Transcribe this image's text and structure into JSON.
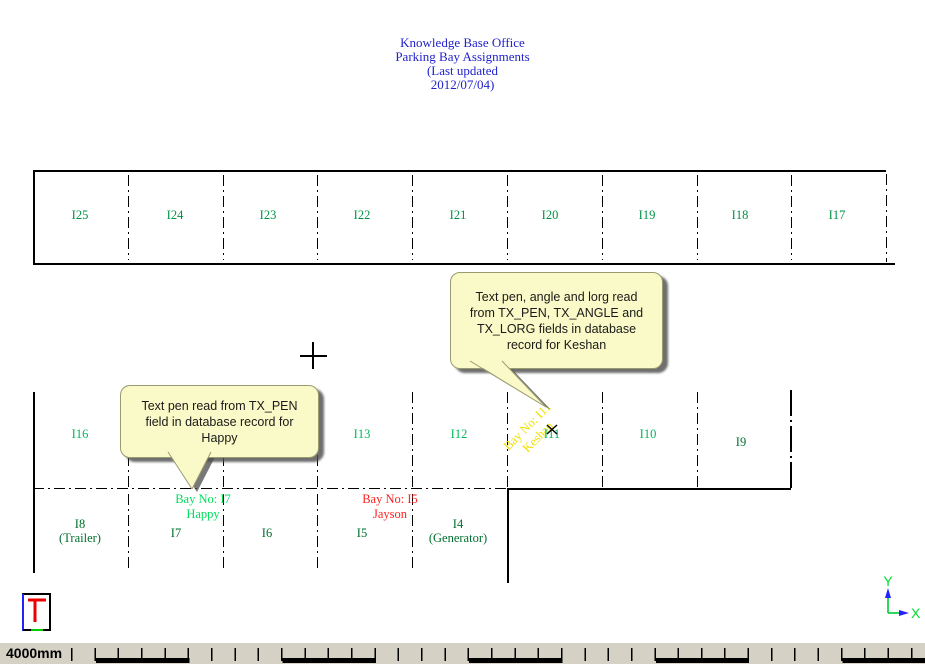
{
  "title": {
    "lines": [
      "Knowledge Base Office",
      "Parking Bay Assignments",
      "(Last updated",
      "2012/07/04)"
    ],
    "color": "#2222cc"
  },
  "drawing": {
    "top_row": {
      "labels": [
        "I25",
        "I24",
        "I23",
        "I22",
        "I21",
        "I20",
        "I19",
        "I18",
        "I17"
      ],
      "label_color": "#009245"
    },
    "middle_row": {
      "labels": [
        "I16",
        "I13",
        "I12",
        "I11",
        "I10",
        "I9"
      ],
      "label_color": "#00b85c",
      "i9_color": "#00702e"
    },
    "bottom_row": {
      "bays": [
        {
          "l1": "I8",
          "l2": "(Trailer)"
        },
        {
          "l1": "I7",
          "l2": ""
        },
        {
          "l1": "I6",
          "l2": ""
        },
        {
          "l1": "I5",
          "l2": ""
        },
        {
          "l1": "I4",
          "l2": "(Generator)"
        }
      ],
      "label_color": "#00702e"
    }
  },
  "bay_tags": {
    "happy": {
      "line1": "Bay No: I7",
      "line2": "Happy",
      "color": "#00e05c"
    },
    "jayson": {
      "line1": "Bay No: I5",
      "line2": "Jayson",
      "color": "#ff1f1f"
    },
    "keshan": {
      "line1": "Bay No: I11",
      "line2": "Keshan",
      "color": "#efe100",
      "rotation_deg": -45
    }
  },
  "callouts": [
    {
      "lines": [
        "Text pen read from TX_PEN",
        "field in database record for",
        "Happy"
      ],
      "bg": "#fafac8"
    },
    {
      "lines": [
        "Text pen, angle and lorg read",
        "from TX_PEN, TX_ANGLE and",
        "TX_LORG fields in database",
        "record for Keshan"
      ],
      "bg": "#fafac8"
    }
  ],
  "axis_indicator": {
    "x_label": "X",
    "y_label": "Y",
    "line_color": "#00cc33",
    "arrow_color": "#2222ff"
  },
  "statusbar": {
    "scale_label": "4000mm",
    "bg": "#d5d1c5"
  }
}
